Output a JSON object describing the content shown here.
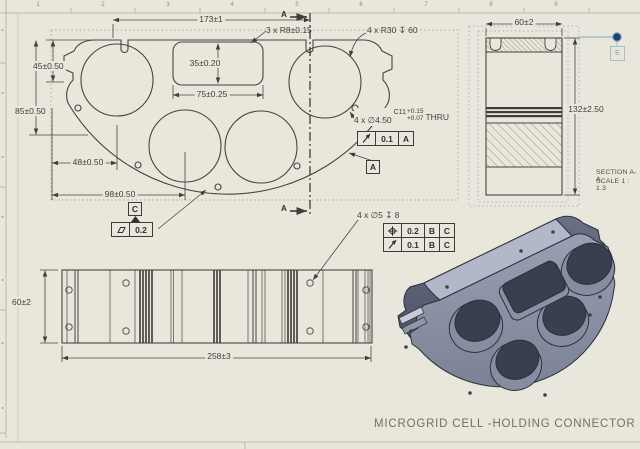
{
  "sheet": {
    "title": "MICROGRID CELL -HOLDING CONNECTOR",
    "zone_numbers": [
      "1",
      "2",
      "3",
      "4",
      "5",
      "6",
      "7",
      "8",
      "9"
    ],
    "background": "#e9e7dc",
    "line_color": "#45453f",
    "selection_box_red": "#d99090",
    "selection_box_blue": "#8fb3cf"
  },
  "main_view": {
    "dim_173": "173±1",
    "dim_45": "45±0.50",
    "dim_85": "85±0.50",
    "dim_35": "35±0.20",
    "dim_75": "75±0.25",
    "dim_48": "48±0.50",
    "dim_98": "98±0.50",
    "note_r8": "3 x R8±0.15",
    "note_r30": "4 x R30 ↧ 60",
    "hole_callout": {
      "qty": "4 x ∅4.50",
      "fit": "C11",
      "tol_upper": "+0.15",
      "tol_lower": "+0.07",
      "thru": "THRU"
    },
    "fcf_runout": {
      "tolerance": "0.1",
      "datum": "A"
    },
    "fcf_flatness": {
      "tolerance": "0.2"
    },
    "datum_a": "A",
    "datum_c": "C",
    "section_arrow_label": "A"
  },
  "section_view": {
    "dim_60": "60±2",
    "dim_132": "132±2.50",
    "caption_line1": "SECTION A-A",
    "caption_line2": "SCALE 1 : 1.3",
    "balloon_label": "E"
  },
  "side_view": {
    "dim_60": "60±2",
    "dim_258": "258±3",
    "hole_callout": "4 x ∅5 ↧ 8",
    "fcf_rows": [
      {
        "symbol": "position",
        "tolerance": "0.2",
        "datum1": "B",
        "datum2": "C"
      },
      {
        "symbol": "runout",
        "tolerance": "0.1",
        "datum1": "B",
        "datum2": "C"
      }
    ]
  }
}
